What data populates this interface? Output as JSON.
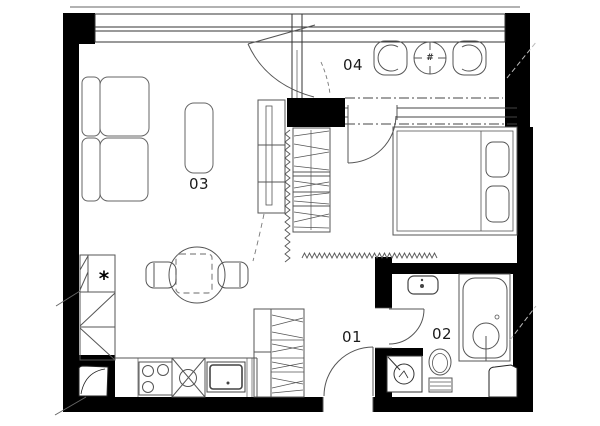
{
  "floorplan": {
    "background": "#ffffff",
    "wall_color": "#000000",
    "line_color": "#4d4d4d",
    "furniture_line_color": "#5a5a5a",
    "rooms": [
      {
        "label": "01"
      },
      {
        "label": "02"
      },
      {
        "label": "03"
      },
      {
        "label": "04"
      }
    ],
    "symbols": {
      "freezer_star": "*",
      "table_hash": "#"
    }
  }
}
